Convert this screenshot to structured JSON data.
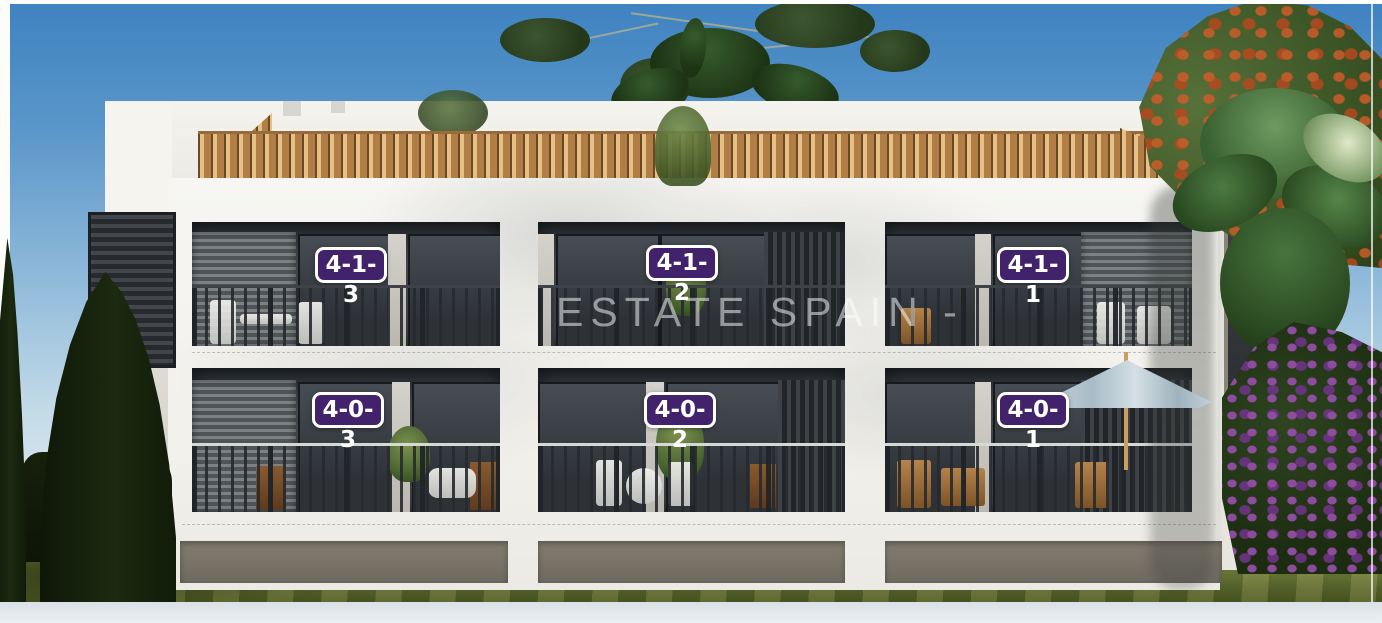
{
  "watermark": {
    "text": "ESTATE SPAIN -"
  },
  "units": [
    {
      "label": "4-1-3"
    },
    {
      "label": "4-1-2"
    },
    {
      "label": "4-1-1"
    },
    {
      "label": "4-0-3"
    },
    {
      "label": "4-0-2"
    },
    {
      "label": "4-0-1"
    }
  ],
  "colors": {
    "badge_purple": "#41226b",
    "badge_border": "#ffffff",
    "badge_text": "#ffffff",
    "sky_top": "#3e82c0",
    "sky_horizon": "#e9f0f3",
    "roof_terracotta": "#b17f46",
    "facade_white": "#f7f6f2",
    "window_dark": "#2e3237",
    "grass_green": "#75813b",
    "watermark_white": "rgba(255,255,255,0.5)"
  }
}
